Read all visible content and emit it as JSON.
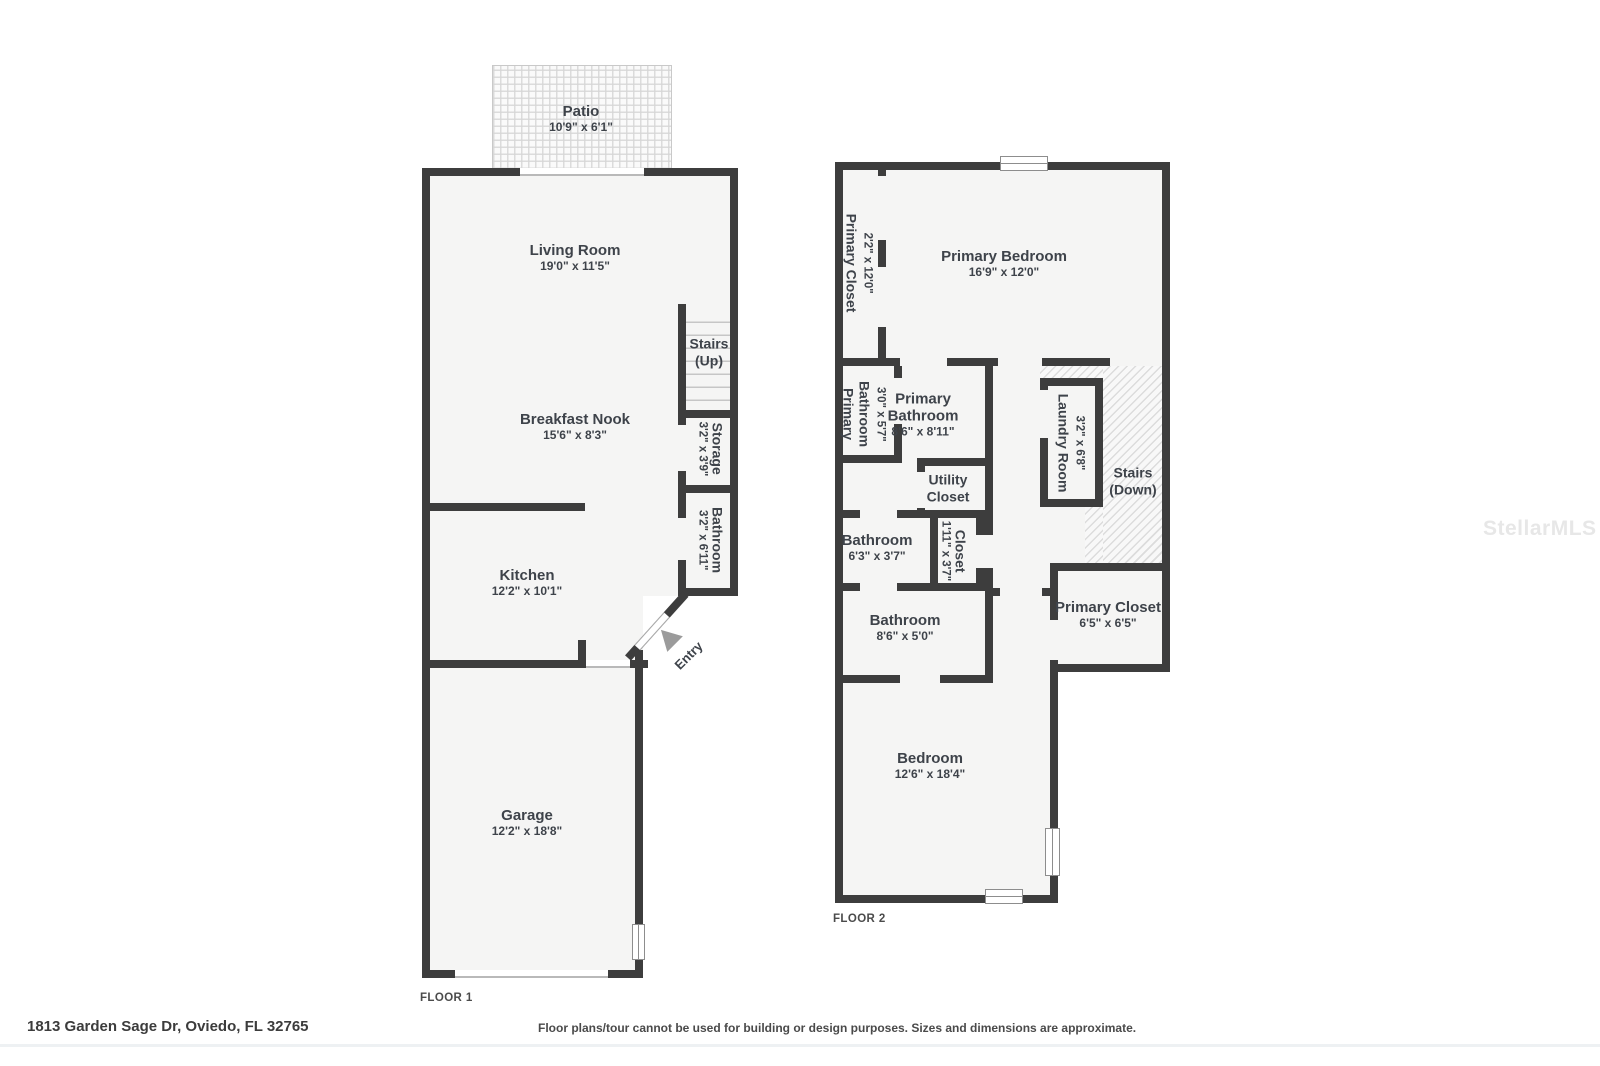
{
  "colors": {
    "wall": "#3d3d3d",
    "room_fill": "#f5f5f4",
    "text": "#3e434a",
    "watermark_text": "#e7e7e7"
  },
  "watermark": "StellarMLS",
  "footer": {
    "address": "1813 Garden Sage Dr, Oviedo, FL 32765",
    "disclaimer": "Floor plans/tour cannot be used for building or design purposes. Sizes and dimensions are approximate."
  },
  "floor1": {
    "label": "FLOOR 1",
    "rooms": {
      "patio": {
        "name": "Patio",
        "dims": "10'9\" x 6'1\""
      },
      "living_room": {
        "name": "Living Room",
        "dims": "19'0\" x 11'5\""
      },
      "stairs_up": {
        "line1": "Stairs",
        "line2": "(Up)"
      },
      "breakfast_nook": {
        "name": "Breakfast Nook",
        "dims": "15'6\" x 8'3\""
      },
      "storage": {
        "name": "Storage",
        "dims": "3'2\" x 3'9\""
      },
      "bathroom": {
        "name": "Bathroom",
        "dims": "3'2\" x 6'11\""
      },
      "kitchen": {
        "name": "Kitchen",
        "dims": "12'2\" x 10'1\""
      },
      "entry": {
        "name": "Entry"
      },
      "garage": {
        "name": "Garage",
        "dims": "12'2\" x 18'8\""
      }
    }
  },
  "floor2": {
    "label": "FLOOR 2",
    "rooms": {
      "primary_closet_left": {
        "name": "Primary Closet",
        "dims": "2'2\" x 12'0\""
      },
      "primary_bedroom": {
        "name": "Primary Bedroom",
        "dims": "16'9\" x 12'0\""
      },
      "primary_bathroom_small": {
        "name_line1": "Primary",
        "name_line2": "Bathroom",
        "dims": "3'0\" x 5'7\""
      },
      "primary_bathroom": {
        "name_line1": "Primary",
        "name_line2": "Bathroom",
        "dims": "8'6\" x 8'11\""
      },
      "laundry_room": {
        "name": "Laundry Room",
        "dims": "3'2\" x 6'8\""
      },
      "stairs_down": {
        "line1": "Stairs",
        "line2": "(Down)"
      },
      "utility_closet": {
        "line1": "Utility",
        "line2": "Closet"
      },
      "bathroom_upper": {
        "name": "Bathroom",
        "dims": "6'3\" x 3'7\""
      },
      "closet": {
        "name": "Closet",
        "dims": "1'11\" x 3'7\""
      },
      "bathroom_lower": {
        "name": "Bathroom",
        "dims": "8'6\" x 5'0\""
      },
      "primary_closet": {
        "name": "Primary Closet",
        "dims": "6'5\" x 6'5\""
      },
      "bedroom": {
        "name": "Bedroom",
        "dims": "12'6\" x 18'4\""
      }
    }
  }
}
